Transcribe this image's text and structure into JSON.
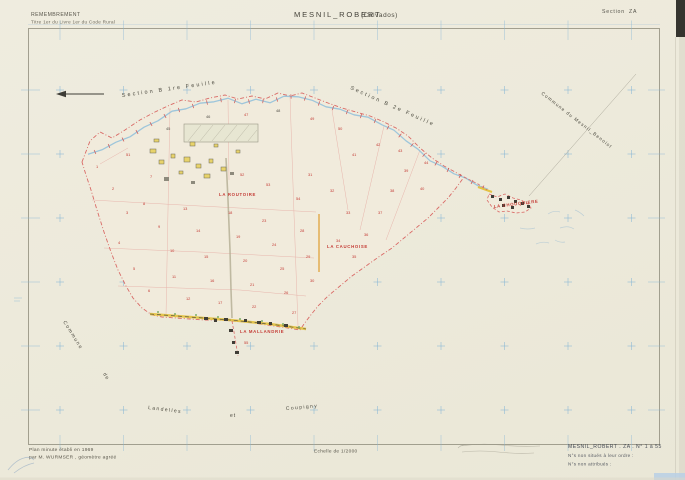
{
  "document": {
    "header": {
      "law_line1": "REMEMBREMENT",
      "law_line2": "Titre 1er du Livre 1er du Code Rural",
      "title": "MESNIL_ROBERT",
      "department": "(Calvados)",
      "section_label": "Section",
      "section_value": "ZA"
    },
    "footer": {
      "minute_line1": "Plan minute établi en 1969",
      "minute_line2": "par M. WURMSER , géomètre agréé",
      "scale_label": "Echelle de 1/2000",
      "ref_title": "MESNIL_ROBERT . ZA . N° 1 à 55",
      "ref_note1": "N°s non situés à leur ordre :",
      "ref_note2": "N°s non attribués :"
    },
    "map": {
      "area_labels": [
        {
          "text": "Section  B  1re  Feuille",
          "x": 122,
          "y": 97,
          "rot": -8,
          "size": 5.4,
          "spacing": 2.2
        },
        {
          "text": "Section  B  2e  Feuille",
          "x": 350,
          "y": 89,
          "rot": 24,
          "size": 5.4,
          "spacing": 2.2
        },
        {
          "text": "Commune  du  Mesnil_Benoist",
          "x": 541,
          "y": 94,
          "rot": 38,
          "size": 4.7,
          "spacing": 1.1
        },
        {
          "text": "Commune",
          "x": 63,
          "y": 322,
          "rot": 58,
          "size": 5.0,
          "spacing": 1.4
        },
        {
          "text": "de",
          "x": 103,
          "y": 374,
          "rot": 58,
          "size": 5.0,
          "spacing": 1.0
        },
        {
          "text": "Landelles",
          "x": 148,
          "y": 409,
          "rot": 7,
          "size": 5.0,
          "spacing": 1.4
        },
        {
          "text": "et",
          "x": 230,
          "y": 417,
          "rot": 0,
          "size": 5.0,
          "spacing": 1.0
        },
        {
          "text": "Coupigny",
          "x": 286,
          "y": 410,
          "rot": -5,
          "size": 5.0,
          "spacing": 1.4
        }
      ],
      "lieux": [
        {
          "text": "LA  ROUTOIRE",
          "x": 219,
          "y": 196,
          "rot": 0
        },
        {
          "text": "LA  CAUCHOISE",
          "x": 327,
          "y": 248,
          "rot": 0
        },
        {
          "text": "LA  MALLANDRIE",
          "x": 240,
          "y": 333,
          "rot": 0
        },
        {
          "text": "LA  CHOUQUIERE",
          "x": 494,
          "y": 208,
          "rot": -7
        }
      ],
      "parcel_numbers": [
        {
          "n": "1",
          "x": 96,
          "y": 168
        },
        {
          "n": "2",
          "x": 112,
          "y": 190
        },
        {
          "n": "3",
          "x": 126,
          "y": 214
        },
        {
          "n": "4",
          "x": 118,
          "y": 244
        },
        {
          "n": "5",
          "x": 133,
          "y": 270
        },
        {
          "n": "6",
          "x": 148,
          "y": 292
        },
        {
          "n": "7",
          "x": 150,
          "y": 178
        },
        {
          "n": "8",
          "x": 143,
          "y": 205
        },
        {
          "n": "9",
          "x": 158,
          "y": 228
        },
        {
          "n": "10",
          "x": 170,
          "y": 252
        },
        {
          "n": "11",
          "x": 172,
          "y": 278
        },
        {
          "n": "12",
          "x": 186,
          "y": 300
        },
        {
          "n": "13",
          "x": 183,
          "y": 210
        },
        {
          "n": "14",
          "x": 196,
          "y": 232
        },
        {
          "n": "15",
          "x": 204,
          "y": 258
        },
        {
          "n": "16",
          "x": 210,
          "y": 282
        },
        {
          "n": "17",
          "x": 218,
          "y": 304
        },
        {
          "n": "18",
          "x": 228,
          "y": 214
        },
        {
          "n": "19",
          "x": 236,
          "y": 238
        },
        {
          "n": "20",
          "x": 243,
          "y": 262
        },
        {
          "n": "21",
          "x": 250,
          "y": 286
        },
        {
          "n": "22",
          "x": 252,
          "y": 308
        },
        {
          "n": "23",
          "x": 262,
          "y": 222
        },
        {
          "n": "24",
          "x": 272,
          "y": 246
        },
        {
          "n": "25",
          "x": 280,
          "y": 270
        },
        {
          "n": "26",
          "x": 284,
          "y": 294
        },
        {
          "n": "27",
          "x": 292,
          "y": 314
        },
        {
          "n": "28",
          "x": 300,
          "y": 232
        },
        {
          "n": "29",
          "x": 306,
          "y": 258
        },
        {
          "n": "30",
          "x": 310,
          "y": 282
        },
        {
          "n": "31",
          "x": 308,
          "y": 176
        },
        {
          "n": "32",
          "x": 330,
          "y": 192
        },
        {
          "n": "33",
          "x": 346,
          "y": 214
        },
        {
          "n": "34",
          "x": 336,
          "y": 242
        },
        {
          "n": "35",
          "x": 352,
          "y": 258
        },
        {
          "n": "36",
          "x": 364,
          "y": 236
        },
        {
          "n": "37",
          "x": 378,
          "y": 214
        },
        {
          "n": "38",
          "x": 390,
          "y": 192
        },
        {
          "n": "39",
          "x": 404,
          "y": 172
        },
        {
          "n": "40",
          "x": 420,
          "y": 190
        },
        {
          "n": "41",
          "x": 352,
          "y": 156
        },
        {
          "n": "42",
          "x": 376,
          "y": 146
        },
        {
          "n": "43",
          "x": 398,
          "y": 152
        },
        {
          "n": "44",
          "x": 424,
          "y": 164
        },
        {
          "n": "45",
          "x": 166,
          "y": 130,
          "c": "k"
        },
        {
          "n": "46",
          "x": 206,
          "y": 118,
          "c": "k"
        },
        {
          "n": "47",
          "x": 244,
          "y": 116
        },
        {
          "n": "48",
          "x": 276,
          "y": 112,
          "c": "k"
        },
        {
          "n": "49",
          "x": 310,
          "y": 120
        },
        {
          "n": "50",
          "x": 338,
          "y": 130
        },
        {
          "n": "51",
          "x": 126,
          "y": 156
        },
        {
          "n": "52",
          "x": 240,
          "y": 176
        },
        {
          "n": "53",
          "x": 266,
          "y": 186
        },
        {
          "n": "54",
          "x": 296,
          "y": 200
        },
        {
          "n": "55",
          "x": 244,
          "y": 344
        }
      ]
    },
    "colors": {
      "paper": "#edeadb",
      "frame": "#8f8d7c",
      "grid_blue": "#85b5d6",
      "boundary_pink": "#d96a66",
      "stream_blue": "#8fc0da",
      "road_yellow": "#e3c344",
      "label_red": "#c43b35",
      "ink": "#4c4a40"
    }
  }
}
